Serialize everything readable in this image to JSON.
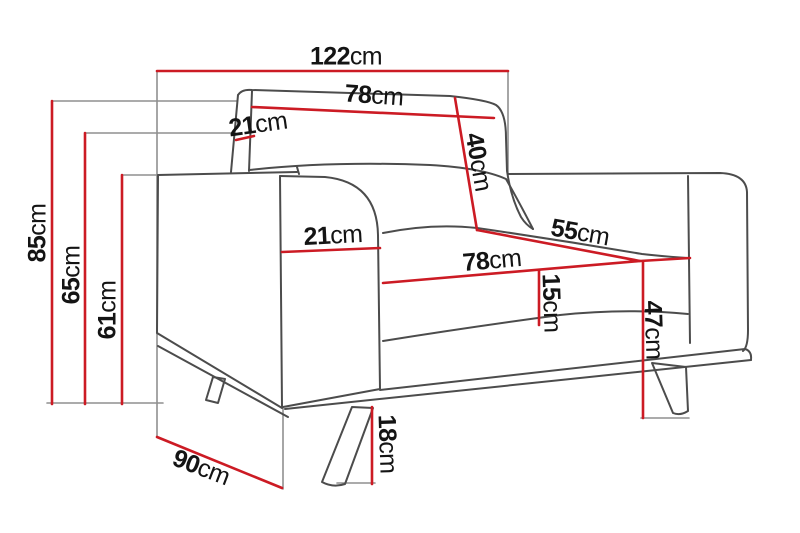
{
  "diagram": {
    "subject": "armchair-dimension-drawing",
    "unit": "cm"
  },
  "colors": {
    "dimension_line": "#cc1b24",
    "extension_line": "#8f8f8f",
    "furniture_line": "#4c4c4c",
    "text": "#141414",
    "background": "#ffffff"
  },
  "dimensions": [
    {
      "id": "total-width",
      "value": "122",
      "unit": "cm"
    },
    {
      "id": "backrest-width",
      "value": "78",
      "unit": "cm"
    },
    {
      "id": "backrest-depth",
      "value": "21",
      "unit": "cm"
    },
    {
      "id": "backrest-height",
      "value": "40",
      "unit": "cm"
    },
    {
      "id": "total-height",
      "value": "85",
      "unit": "cm"
    },
    {
      "id": "back-height",
      "value": "65",
      "unit": "cm"
    },
    {
      "id": "armrest-height",
      "value": "61",
      "unit": "cm"
    },
    {
      "id": "armrest-width",
      "value": "21",
      "unit": "cm"
    },
    {
      "id": "seat-depth",
      "value": "55",
      "unit": "cm"
    },
    {
      "id": "seat-width",
      "value": "78",
      "unit": "cm"
    },
    {
      "id": "cushion-height",
      "value": "15",
      "unit": "cm"
    },
    {
      "id": "seat-height",
      "value": "47",
      "unit": "cm"
    },
    {
      "id": "leg-height",
      "value": "18",
      "unit": "cm"
    },
    {
      "id": "total-depth",
      "value": "90",
      "unit": "cm"
    }
  ]
}
